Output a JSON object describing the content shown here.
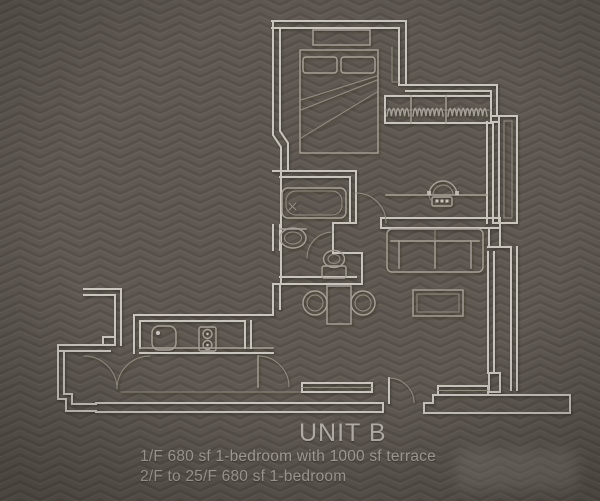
{
  "labels": {
    "unit_name": "UNIT B",
    "caption_line1": "1/F 680 sf 1-bedroom with 1000 sf terrace",
    "caption_line2": "2/F to 25/F 680 sf 1-bedroom"
  },
  "colors": {
    "background": "#5f5952",
    "pattern_dark": "#514b45",
    "pattern_light": "#6b655d",
    "plan_line": "#c9c5bd",
    "furniture_line": "#a59f96",
    "dim_line": "#938d84",
    "text_primary": "#b6b2a9",
    "text_secondary": "#aba69d"
  },
  "plan": {
    "type": "architectural-floor-plan",
    "unit": "UNIT B",
    "features": [
      "double-bed",
      "wardrobe-with-hangers",
      "bay-window",
      "bathtub",
      "washbasin",
      "toilet",
      "sofa",
      "coffee-table",
      "console-with-chair",
      "dining-table-two-chairs",
      "kitchen-sink",
      "two-burner-hob",
      "terrace-doors",
      "entry-door",
      "terrace-parapet"
    ]
  }
}
